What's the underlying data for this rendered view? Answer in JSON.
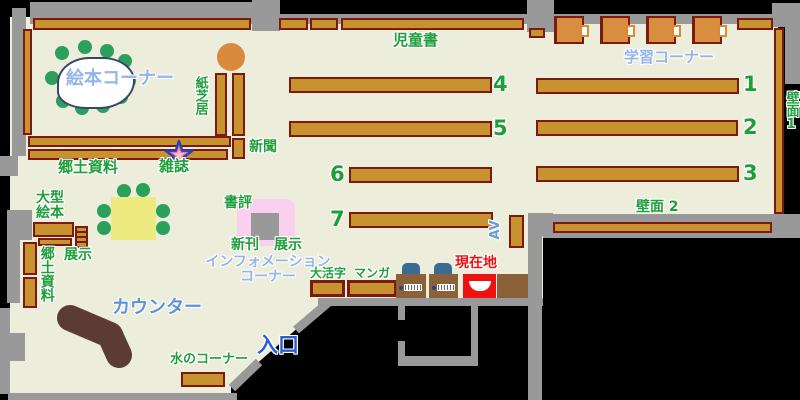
{
  "labels": {
    "ehon_corner": "絵本コーナー",
    "kamishibai": "紙芝居",
    "shinbun": "新聞",
    "zasshi": "雑誌",
    "kyodo_shiryo_top": "郷土資料",
    "ogata_ehon_line1": "大型",
    "ogata_ehon_line2": "絵本",
    "tenji_left": "展示",
    "kyodo_shiryo_left": "郷土資料",
    "counter": "カウンター",
    "mizu_no_corner": "水のコーナー",
    "iriguchi": "入口",
    "shohyo": "書評",
    "shinkan": "新刊",
    "tenji_center": "展示",
    "information_line1": "インフォメーション",
    "information_line2": "コーナー",
    "daikatsuji": "大活字",
    "manga": "マンガ",
    "jidosho": "児童書",
    "gakushu_corner": "学習コーナー",
    "av": "AV",
    "hekimen_1": "壁面1",
    "hekimen_2": "壁面 2",
    "genzaichi": "現在地"
  },
  "shelf_numbers": {
    "n1": "1",
    "n2": "2",
    "n3": "3",
    "n4": "4",
    "n5": "5",
    "n6": "6",
    "n7": "7"
  },
  "colors": {
    "floor": "#EDEDDC",
    "wall": "#999999",
    "shelf_fill": "#C8922E",
    "shelf_border": "#7A1A10",
    "green_label": "#1F9E3C",
    "blue_label": "#2B5FD0",
    "light_blue_label": "#93B5EA",
    "mid_blue_label": "#5E93DB",
    "red_marker": "#EE1111",
    "pink_display": "#FBD0EE",
    "yellow_table": "#EDEA7F",
    "chair_green": "#2AA05C",
    "tree_orange": "#D98A3C",
    "counter_brown": "#5C3B34",
    "pc_desk_brown": "#8B6139",
    "pc_chair_blue": "#3A6B96",
    "star_outline": "#2A3FC0",
    "star_fill": "#F2798C"
  }
}
